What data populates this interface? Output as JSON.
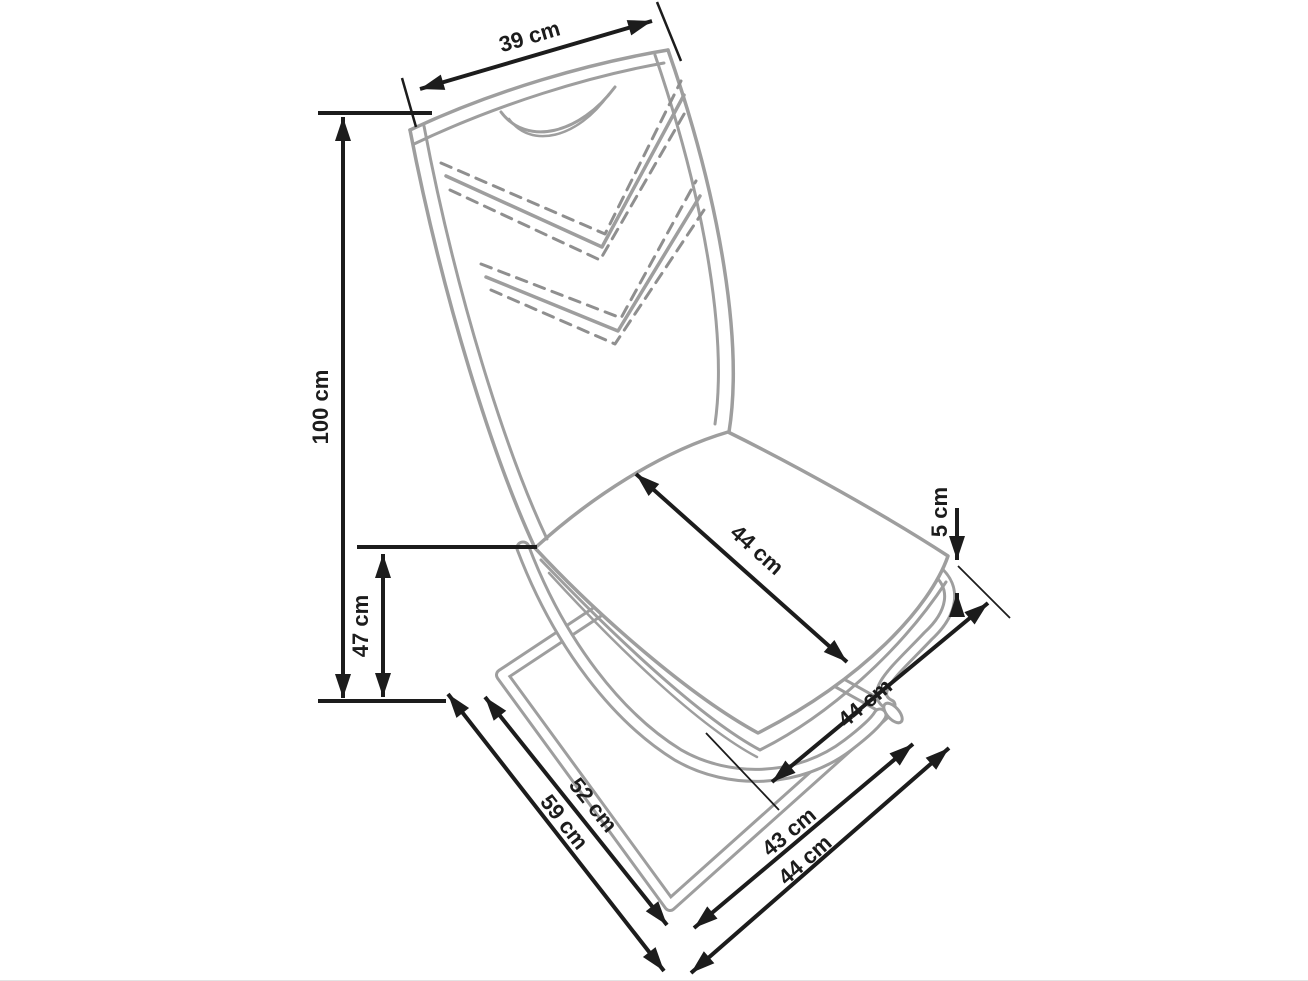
{
  "figure": {
    "kind": "product-dimension-diagram",
    "unit": "cm"
  },
  "colors": {
    "background": "#ffffff",
    "dimension_lines": "#1c1c1c",
    "chair_outline": "#9e9e9e",
    "stitching": "#8f8f8f"
  },
  "dimensions": {
    "backrest_width": {
      "label": "39 cm",
      "value": 39
    },
    "total_height": {
      "label": "100 cm",
      "value": 100
    },
    "seat_height": {
      "label": "47 cm",
      "value": 47
    },
    "seat_depth": {
      "label": "44 cm",
      "value": 44
    },
    "frame_gap": {
      "label": "5 cm",
      "value": 5
    },
    "seat_side_depth": {
      "label": "44 cm",
      "value": 44
    },
    "base_length_inner": {
      "label": "52 cm",
      "value": 52
    },
    "base_length_outer": {
      "label": "59 cm",
      "value": 59
    },
    "base_width_inner": {
      "label": "43 cm",
      "value": 43
    },
    "base_width_outer": {
      "label": "44 cm",
      "value": 44
    }
  }
}
